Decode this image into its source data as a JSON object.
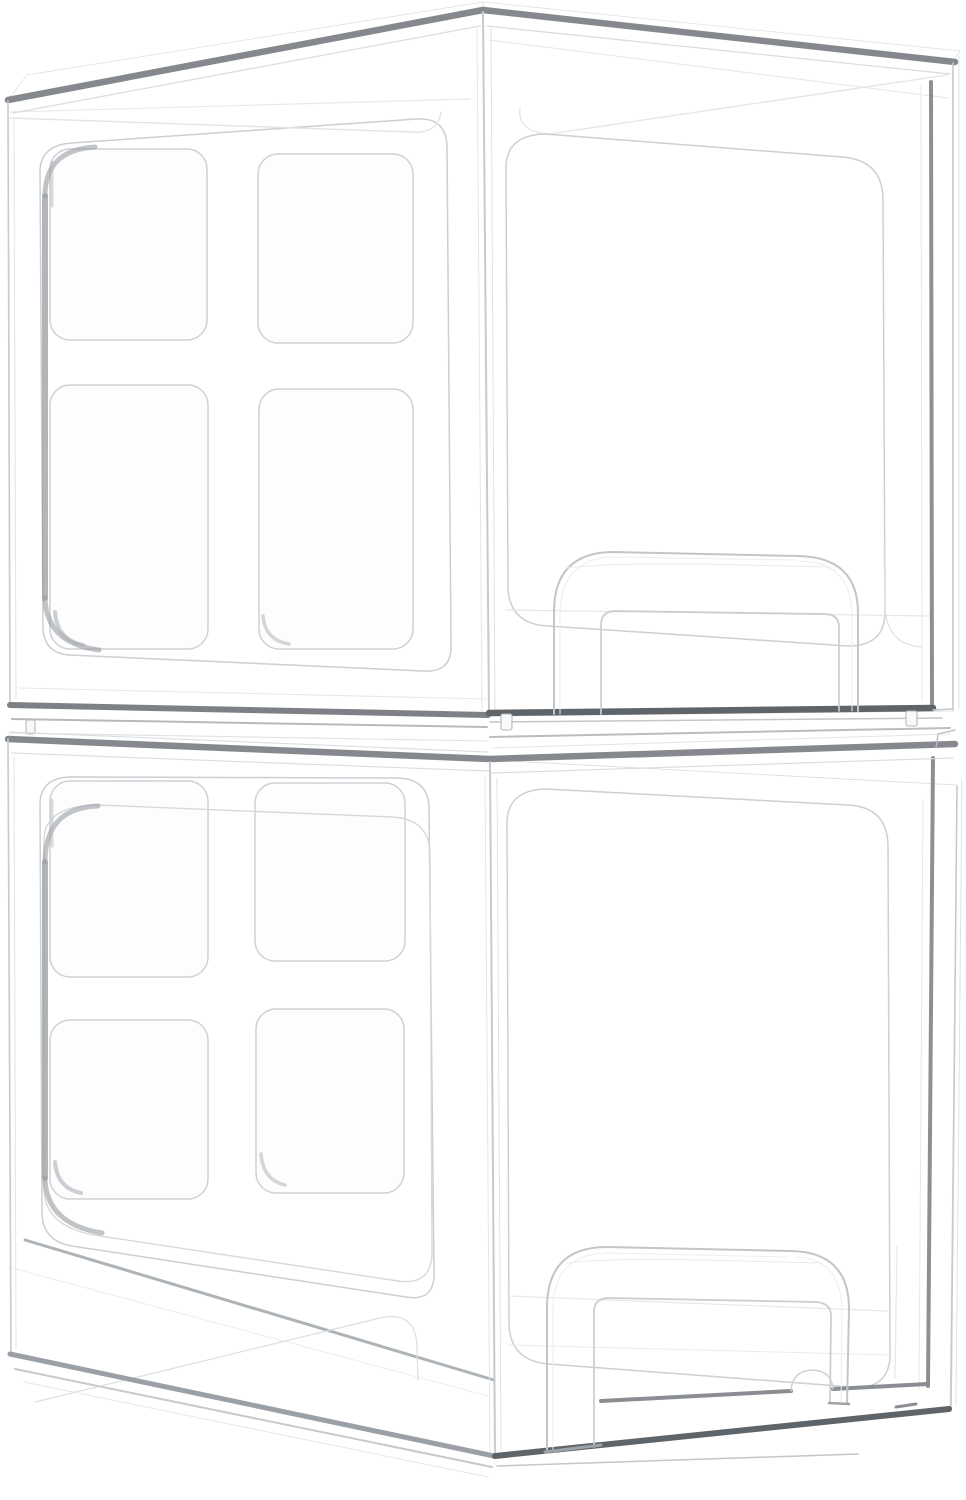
{
  "scene": {
    "type": "product-photo",
    "background": "#ffffff",
    "subject": "Two clear transparent stackable acrylic storage drawer organizers stacked vertically",
    "view": "three-quarter perspective showing left side panel and front drawer face",
    "units": [
      {
        "name": "top storage drawer",
        "position": "top",
        "material_look": "clear transparent acrylic",
        "side_panel": {
          "grid_rows": 2,
          "grid_cols": 2,
          "cells": 4,
          "cell_shape": "rounded square"
        },
        "front": "recessed rounded drawer panel",
        "handle": "arched U-shaped pull handle at bottom of drawer front"
      },
      {
        "name": "bottom storage drawer",
        "position": "bottom",
        "material_look": "clear transparent acrylic",
        "side_panel": {
          "grid_rows": 2,
          "grid_cols": 2,
          "cells": 4,
          "cell_shape": "rounded square"
        },
        "front": "recessed rounded drawer panel",
        "handle": "arched U-shaped pull handle at bottom of drawer front"
      }
    ]
  },
  "colors": {
    "background": "#ffffff",
    "rim_gray": "#85898e",
    "band_dark": "#5f6468",
    "accent_gray": "#989da2",
    "inner_edge_dark": "#7f8489",
    "line_light": "#c9cdd1",
    "line_faint": "#e4e6e9",
    "face_highlight": "#fcfdfe",
    "face_shadow": "#f2f3f5"
  }
}
